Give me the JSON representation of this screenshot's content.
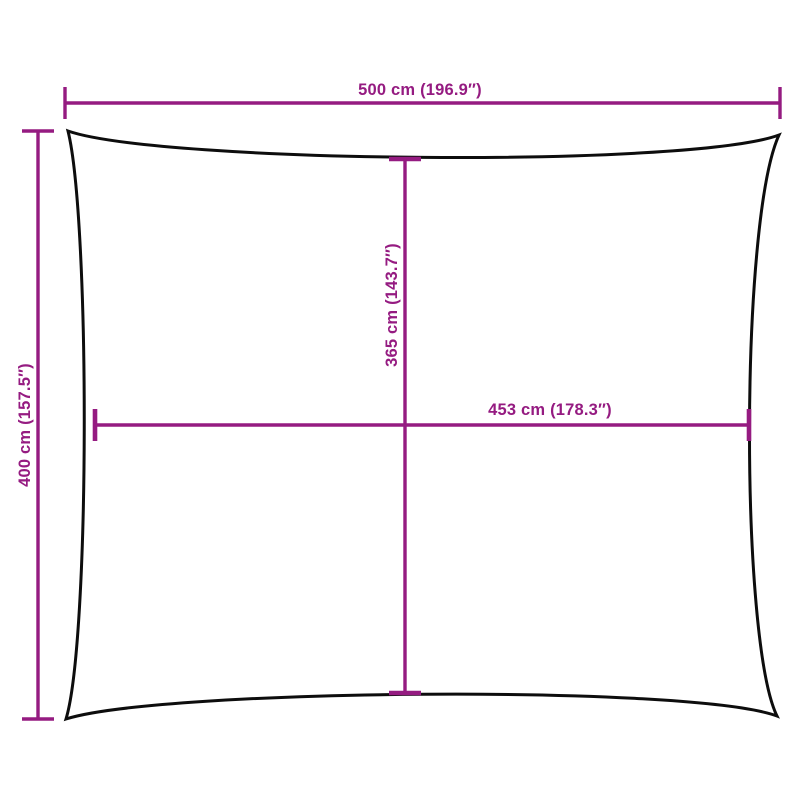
{
  "colors": {
    "dimension": "#951b81",
    "outline": "#0d0d0d",
    "background": "#ffffff"
  },
  "diagram": {
    "kind": "product-dimension-diagram",
    "shape": "rectangle-concave-edges",
    "labels": {
      "top_width": "500 cm (196.9″)",
      "left_height": "400 cm (157.5″)",
      "inner_height": "365 cm (143.7″)",
      "inner_width": "453 cm (178.3″)"
    }
  }
}
